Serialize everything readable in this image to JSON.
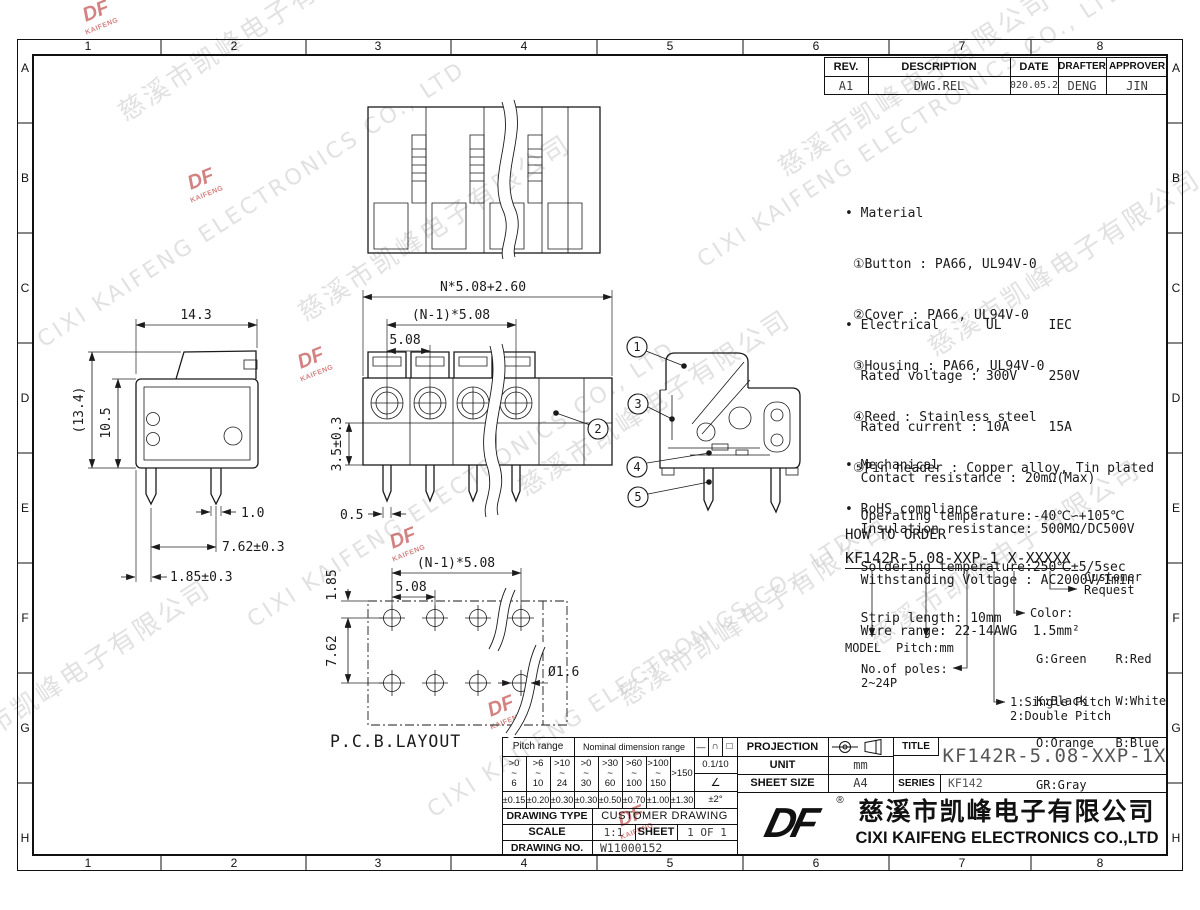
{
  "border": {
    "columns": [
      "1",
      "2",
      "3",
      "4",
      "5",
      "6",
      "7",
      "8"
    ],
    "rows": [
      "A",
      "B",
      "C",
      "D",
      "E",
      "F",
      "G",
      "H"
    ]
  },
  "watermark": {
    "cn": "慈溪市凯峰电子有限公司",
    "en": "CIXI KAIFENG ELECTRONICS CO., LTD",
    "logo_top": "DF",
    "logo_bottom": "KAIFENG"
  },
  "revision": {
    "headers": [
      "REV.",
      "DESCRIPTION",
      "DATE",
      "DRAFTER",
      "APPROVER"
    ],
    "row": [
      "A1",
      "DWG.REL",
      "2020.05.27",
      "DENG",
      "JIN"
    ]
  },
  "notes": {
    "material_title": "• Material",
    "material": [
      " ①Button : PA66, UL94V-0",
      " ②Cover : PA66, UL94V-0",
      " ③Housing : PA66, UL94V-0",
      " ④Reed : Stainless steel",
      " ⑤Pin header : Copper alloy, Tin plated"
    ],
    "electrical_title": "• Electrical      UL      IEC",
    "electrical": [
      "  Rated voltage : 300V    250V",
      "  Rated current : 10A     15A",
      "  Contact resistance : 20mΩ(Max)",
      "  Insulation resistance: 500MΩ/DC500V",
      "  Withstanding Voltage : AC2000V/1min",
      "  Wire range: 22-14AWG  1.5mm²"
    ],
    "mechanical_title": "• Mechanical",
    "mechanical": [
      "  Operating temperature:-40℃∽+105℃",
      "  Soldering temperature:250℃±5/5sec",
      "  Strip length: 10mm"
    ],
    "rohs": "• RoHS compliance"
  },
  "order": {
    "title": "HOW TO ORDER",
    "code1": "KF142R-5.08-XXP-1",
    "code2": "X-XXXXX",
    "model": "MODEL",
    "pitch": "Pitch:mm",
    "poles1": "No.of poles:",
    "poles2": "2~24P",
    "single": "1:Single Pitch",
    "double": "2:Double Pitch",
    "color_title": "Color:",
    "colors": [
      "G:Green    R:Red",
      "K:Black    W:White",
      "O:Orange   B:Blue",
      "GR:Gray"
    ],
    "customer1": "Customer",
    "customer2": "Request"
  },
  "callouts": [
    "1",
    "2",
    "3",
    "4",
    "5"
  ],
  "dims": {
    "front_total": "N*5.08+2.60",
    "front_span": "(N-1)*5.08",
    "front_pitch": "5.08",
    "front_height": "3.5±0.3",
    "front_pin": "0.5",
    "side_width": "14.3",
    "side_total_h": "(13.4)",
    "side_body_h": "10.5",
    "pin_width": "1.0",
    "pin_span": "7.62±0.3",
    "pin_offset": "1.85±0.3",
    "pcb_span": "(N-1)*5.08",
    "pcb_pitch": "5.08",
    "pcb_offset": "1.85",
    "pcb_row_gap": "7.62",
    "pcb_hole": "Ø1.6",
    "pcb_label": "P.C.B.LAYOUT"
  },
  "titleblock": {
    "pitch_range": "Pitch range",
    "nominal_range": "Nominal dimension range",
    "sym_line": "—",
    "sym_arc": "∩",
    "sym_square": "□",
    "tilde": "~",
    "range_top": [
      ">0",
      ">6",
      ">10",
      ">0",
      ">30",
      ">60",
      ">100"
    ],
    "range_bottom": [
      "6",
      "10",
      "24",
      "30",
      "60",
      "100",
      "150"
    ],
    "range_last": ">150",
    "flatness": "0.1/10",
    "angle_sym": "∠",
    "tolerances": [
      "±0.15",
      "±0.20",
      "±0.30",
      "±0.30",
      "±0.50",
      "±0.70",
      "±1.00",
      "±1.30"
    ],
    "angle_tol": "±2°",
    "drawing_type_label": "DRAWING TYPE",
    "drawing_type": "CUSTOMER DRAWING",
    "scale_label": "SCALE",
    "scale": "1:1",
    "sheet_label": "SHEET",
    "sheet": "1 OF 1",
    "drawing_no_label": "DRAWING NO.",
    "drawing_no": "W11000152",
    "projection_label": "PROJECTION",
    "unit_label": "UNIT",
    "unit": "mm",
    "sheet_size_label": "SHEET SIZE",
    "sheet_size": "A4",
    "title_label": "TITLE",
    "title": "KF142R-5.08-XXP-1X",
    "series_label": "SERIES",
    "series": "KF142",
    "logo": "DF",
    "reg": "®",
    "company_cn": "慈溪市凯峰电子有限公司",
    "company_en": "CIXI KAIFENG ELECTRONICS CO.,LTD"
  }
}
